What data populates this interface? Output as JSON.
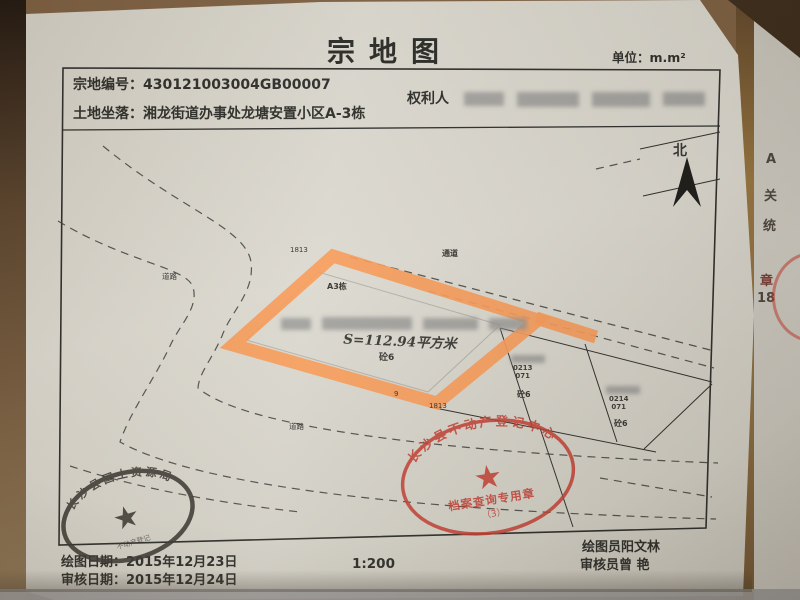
{
  "header": {
    "title": "宗地图",
    "unit": "单位：m.m²",
    "parcel_no_label": "宗地编号：",
    "parcel_no": "430121003004GB00007",
    "location_label": "土地坐落：",
    "location": "湘龙街道办事处龙塘安置小区A-3栋",
    "rights_holder_label": "权利人"
  },
  "map": {
    "north_label": "北",
    "road_label_left": "道路",
    "road_label_bottom": "道路",
    "passage_label": "通道",
    "corner_point_top": "1813",
    "corner_point_bottom": "1813",
    "point_9": "9",
    "building_label": "A3栋",
    "parcel": {
      "area_text": "S=112.94平方米",
      "structure_label": "砼6"
    },
    "neighbor_parcels": [
      {
        "code": "0213",
        "code2": "071",
        "structure": "砼6"
      },
      {
        "code": "0214",
        "code2": "071",
        "structure": "砼6"
      }
    ]
  },
  "stamps": {
    "red": {
      "ring_text": "长沙县不动产登记中心",
      "title": "档案查询专用章",
      "number": "（3）"
    },
    "dark": {
      "ring_text": "长沙县国土资源局",
      "inner_text": "不动产登记"
    }
  },
  "footer": {
    "draw_date_label": "绘图日期：",
    "draw_date": "2015年12月23日",
    "review_date_label": "审核日期：",
    "review_date": "2015年12月24日",
    "scale": "1:200",
    "drafter_label": "绘图员",
    "drafter_name": "阳文林",
    "reviewer_label": "审核员",
    "reviewer_name": "曾  艳"
  },
  "adjacent_page": {
    "char_a": "A",
    "char_guan": "关",
    "char_tong": "统",
    "char_zhang": "章",
    "num_18": "18"
  },
  "colors": {
    "parcel_highlight": "#f79a57",
    "stamp_red": "#c23a2e",
    "stamp_dark": "#38352f"
  }
}
